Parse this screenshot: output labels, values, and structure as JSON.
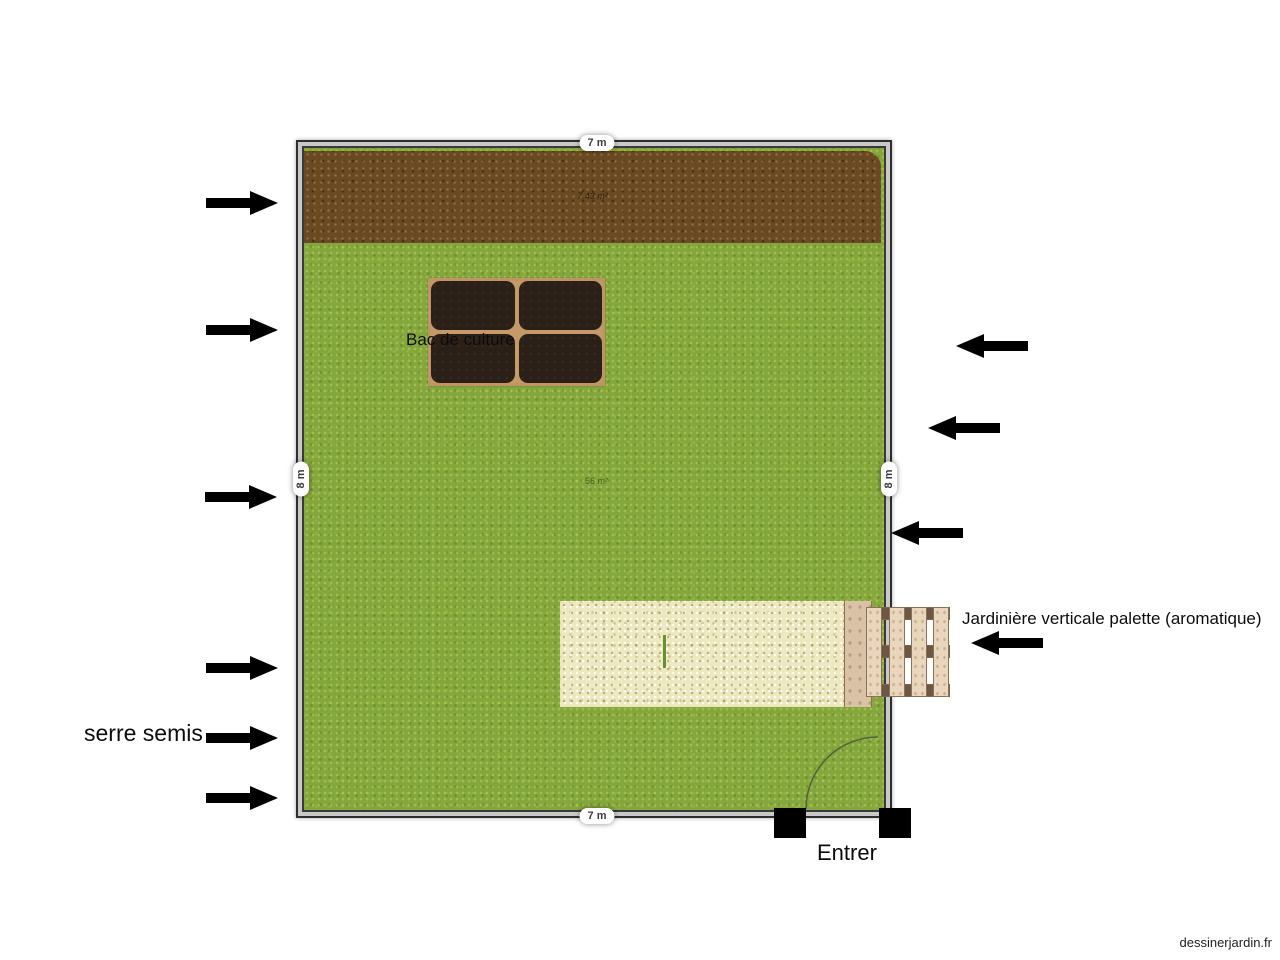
{
  "watermark": "dessinerjardin.fr",
  "dimensions": {
    "top": "7 m",
    "bottom": "7 m",
    "left": "8 m",
    "right": "8 m"
  },
  "areas": {
    "dirt_bed": "7.43 m²",
    "lawn": "56 m²"
  },
  "labels": {
    "bac_de_culture": "Bac de culture",
    "serre_semis": "serre semis",
    "jardiniere": "Jardinière verticale palette (aromatique)",
    "entrance": "Entrer"
  },
  "icons": {
    "arrow_right_count": 6,
    "arrow_left_count": 4,
    "door_swing": "quarter-circle arc at entrance"
  },
  "colors": {
    "lawn_green": "#84a73d",
    "dirt_brown": "#6a4a22",
    "gravel_beige": "#ece8c0",
    "planter_frame": "#c49a68",
    "planter_soil": "#2b2018",
    "pallet_wood": "#e9d6bd",
    "wall_gray": "#2e2e2e",
    "arrow_black": "#000000"
  }
}
